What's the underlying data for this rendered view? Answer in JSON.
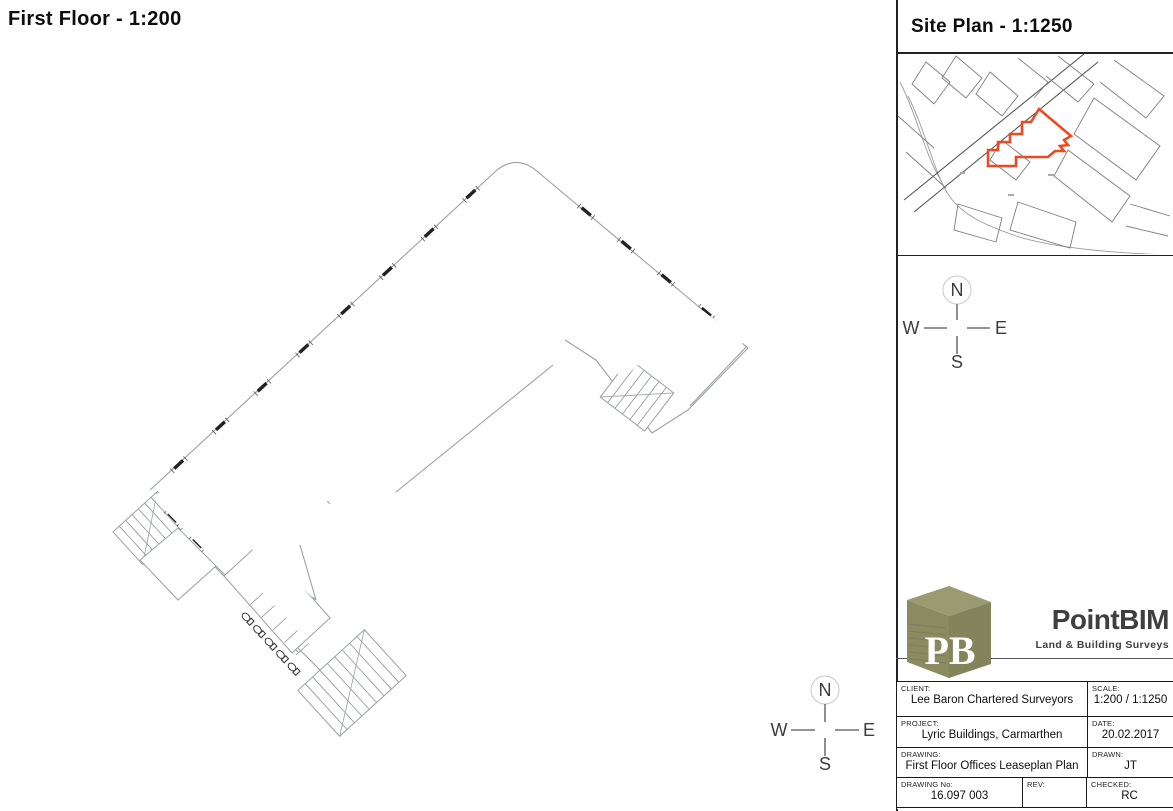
{
  "main": {
    "title": "First Floor - 1:200"
  },
  "site_panel": {
    "title": "Site Plan - 1:1250"
  },
  "compass": {
    "north": "N",
    "east": "E",
    "south": "S",
    "west": "W"
  },
  "logo": {
    "monogram": "PB",
    "name": "PointBIM",
    "tagline": "Land & Building Surveys"
  },
  "title_block": {
    "rows": [
      {
        "cells": [
          {
            "label": "CLIENT:",
            "value": "Lee Baron Chartered Surveyors"
          },
          {
            "label": "SCALE:",
            "value": "1:200 / 1:1250"
          }
        ]
      },
      {
        "cells": [
          {
            "label": "PROJECT:",
            "value": "Lyric Buildings, Carmarthen"
          },
          {
            "label": "DATE:",
            "value": "20.02.2017"
          }
        ]
      },
      {
        "cells": [
          {
            "label": "DRAWING:",
            "value": "First Floor Offices Leaseplan Plan"
          },
          {
            "label": "DRAWN:",
            "value": "JT"
          }
        ]
      },
      {
        "cells": [
          {
            "label": "DRAWING No:",
            "value": "16.097 003"
          },
          {
            "label": "REV:",
            "value": ""
          },
          {
            "label": "CHECKED:",
            "value": "RC"
          }
        ]
      }
    ]
  },
  "colors": {
    "lease": "#ee4a21",
    "wall": "#9aa0a4",
    "logo_olive": "#8b8b62",
    "ink": "#1a1a1a"
  }
}
